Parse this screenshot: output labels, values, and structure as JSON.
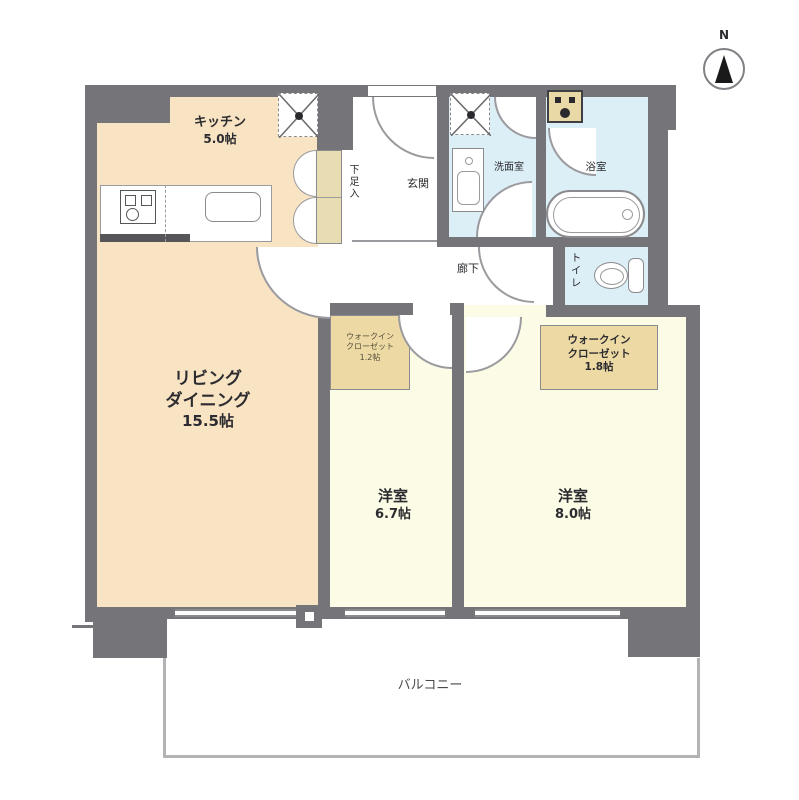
{
  "rooms": {
    "kitchen": {
      "name": "キッチン",
      "area": "5.0帖"
    },
    "living_dining": {
      "name_line1": "リビング",
      "name_line2": "ダイニング",
      "area": "15.5帖"
    },
    "bedroom_67": {
      "name": "洋室",
      "area": "6.7帖"
    },
    "bedroom_80": {
      "name": "洋室",
      "area": "8.0帖"
    },
    "wic_12": {
      "name_line1": "ウォークイン",
      "name_line2": "クローゼット",
      "area": "1.2帖"
    },
    "wic_18": {
      "name_line1": "ウォークイン",
      "name_line2": "クローゼット",
      "area": "1.8帖"
    },
    "entrance": {
      "name": "玄関"
    },
    "hallway": {
      "name": "廊下"
    },
    "washroom": {
      "name": "洗面室"
    },
    "bathroom": {
      "name": "浴室"
    },
    "toilet": {
      "name": "トイレ"
    },
    "shoe_storage": {
      "name": "下足入"
    },
    "balcony": {
      "name": "バルコニー"
    }
  },
  "compass": {
    "label": "N"
  },
  "colors": {
    "wall": "#757579",
    "living_fill": "#f8e3c2",
    "bedroom_fill": "#fbfbe6",
    "closet_fill": "#ecd9a4",
    "water_fill": "#dceef6"
  }
}
